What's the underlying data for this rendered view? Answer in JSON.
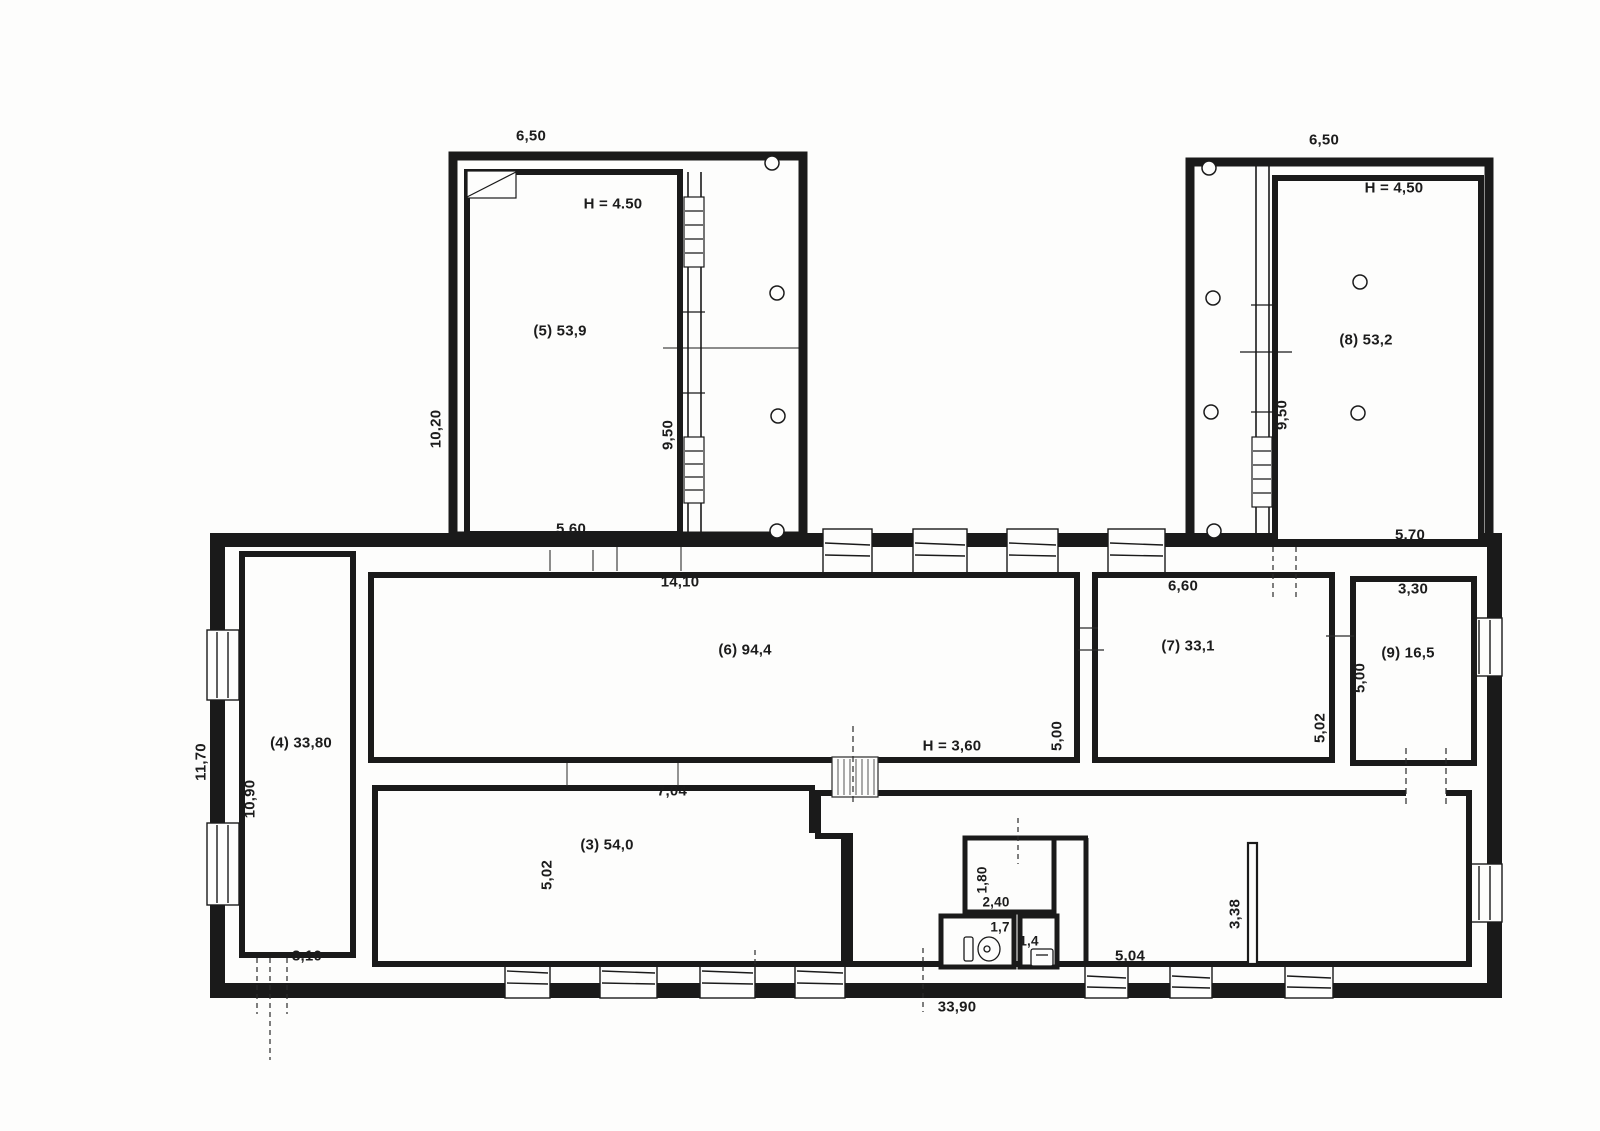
{
  "page": {
    "background": "#fdfdfc",
    "ink": "#1a1a1a"
  },
  "wing_left": {
    "top_width": "6,50",
    "ceiling_height": "H = 4.50",
    "room_label": "(5) 53,9",
    "outer_side": "10,20",
    "inner_side": "9,50",
    "bottom_width": "5,60"
  },
  "wing_right": {
    "top_width": "6,50",
    "ceiling_height": "H = 4,50",
    "room_label": "(8) 53,2",
    "inner_side": "9,50",
    "bottom_width": "5,70"
  },
  "hall6": {
    "room_label": "(6) 94,4",
    "top_width": "14,10",
    "ceiling_height": "H = 3,60",
    "right_side": "5,00"
  },
  "room7": {
    "room_label": "(7) 33,1",
    "top_width": "6,60",
    "right_side": "5,02"
  },
  "room9": {
    "room_label": "(9) 16,5",
    "top_width": "3,30",
    "left_side": "5,00"
  },
  "room4": {
    "room_label": "(4) 33,80",
    "outer_side": "11,70",
    "inner_side": "10,90",
    "bottom_width": "3,10"
  },
  "room3": {
    "room_label": "(3) 54,0",
    "top_width": "7,04",
    "left_side": "5,02"
  },
  "wc_block": {
    "depth": "1,80",
    "width": "2,40",
    "toilet_room": "1,7",
    "washroom": "1,4"
  },
  "bottom_right": {
    "partition": "3,38",
    "width": "5,04"
  },
  "overall": {
    "bottom_width": "33,90"
  }
}
